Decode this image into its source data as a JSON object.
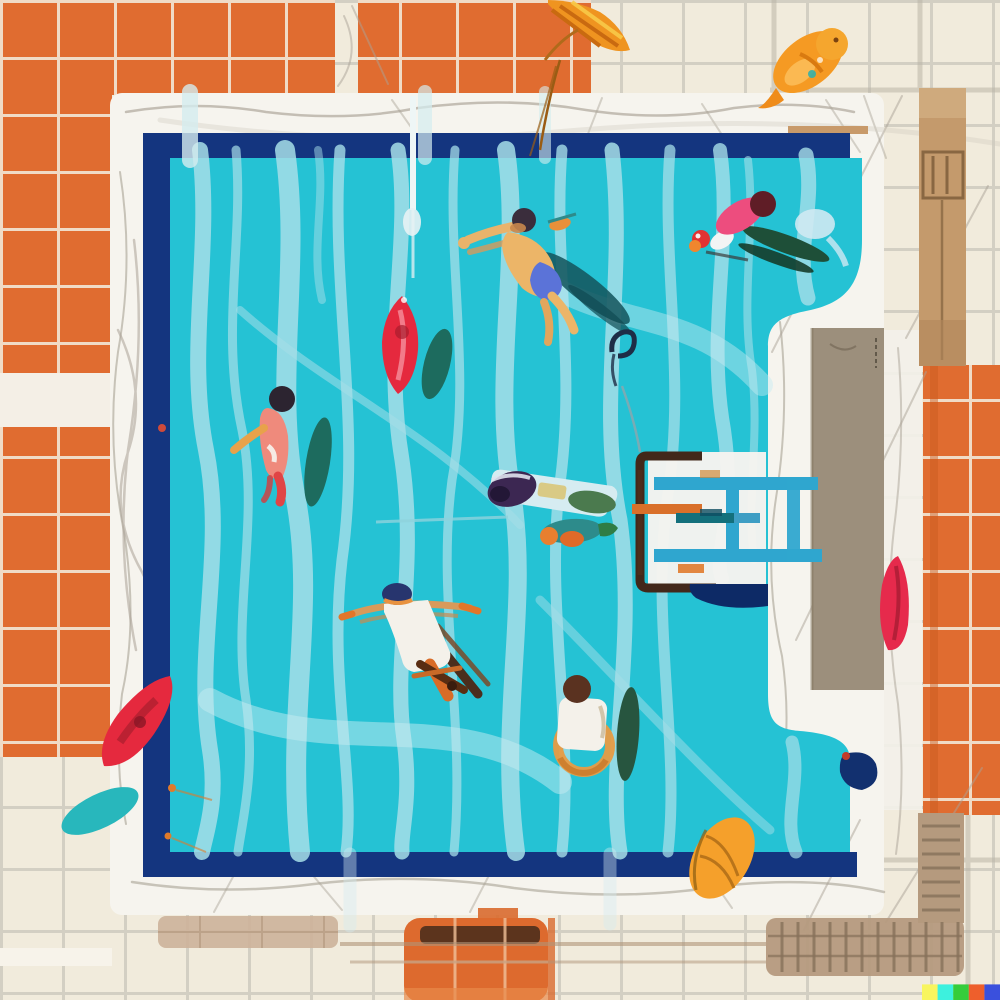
{
  "scene": {
    "type": "illustration",
    "description": "Top-down flat illustration of an outdoor swimming pool: turquoise water with wavy light-blue reflections, six swimmers, pool floats, a blue ladder platform on the right, white marble deck, and orange and cream ceramic tile surround."
  },
  "palette": {
    "tile_beige": "#f1ebdc",
    "grout_beige": "#d3cfc3",
    "tile_orange": "#e06c30",
    "grout_orange": "#f2e7d6",
    "deck_white": "#f6f4ee",
    "sketch_gray": "#a9a195",
    "pool_navy": "#14357f",
    "navy_deep": "#0d2a66",
    "water": "#25c2d4",
    "streak": "#a6dee8",
    "streak_pale": "#c6ebf1",
    "platform_taupe": "#9c8f7c",
    "grate_tan": "#b59a7e",
    "grate_line": "#86705a",
    "column_tan": "#c49a6c",
    "ladder_blue": "#2fa6cf",
    "frame_brown": "#42281a",
    "accent_orange": "#d9702a",
    "wood_strip": "#c89a6a"
  },
  "objects": {
    "swimmers": [
      {
        "name": "freestyle swimmer in blue shorts",
        "colors": [
          "#ecb568",
          "#5b73d8",
          "#3a2d3c"
        ]
      },
      {
        "name": "swimmer in pink suit with dark fins",
        "colors": [
          "#ed4d7e",
          "#5f1d26",
          "#1e4f38"
        ]
      },
      {
        "name": "swimmer in salmon suit",
        "colors": [
          "#ef8a7c",
          "#2c2430",
          "#e04545"
        ]
      },
      {
        "name": "swimmer with purple cap on pale kickboard",
        "colors": [
          "#3c2752",
          "#d6ecf1",
          "#4b7a4e"
        ]
      },
      {
        "name": "floating swimmer in white trunks",
        "colors": [
          "#f4f1ea",
          "#27356e",
          "#d96c28"
        ]
      },
      {
        "name": "swimmer in white shirt with orange swim ring",
        "colors": [
          "#f4f1ea",
          "#5a3220",
          "#e89b43"
        ]
      }
    ],
    "floats": [
      {
        "name": "red surfboard float",
        "color": "#e5293e"
      },
      {
        "name": "teal board shadow",
        "color": "#1d6b5e"
      },
      {
        "name": "red kayak float",
        "color": "#e5293e"
      },
      {
        "name": "teal leaf float",
        "color": "#28b7bc"
      },
      {
        "name": "orange oval float",
        "color": "#f5a02b"
      },
      {
        "name": "red surfboard on deck",
        "color": "#e62a4c"
      },
      {
        "name": "orange koi fish",
        "color": "#f59a23"
      },
      {
        "name": "orange palm frond",
        "color": "#ef9420"
      }
    ],
    "structures": [
      {
        "name": "pool ladder platform"
      },
      {
        "name": "taupe side platform"
      },
      {
        "name": "tan drain grate"
      },
      {
        "name": "orange mat"
      },
      {
        "name": "stone column"
      }
    ]
  },
  "watermark": {
    "colors": [
      "#f8f55e",
      "#3df1de",
      "#35cd3b",
      "#ee5f2c",
      "#3a50dd"
    ]
  }
}
